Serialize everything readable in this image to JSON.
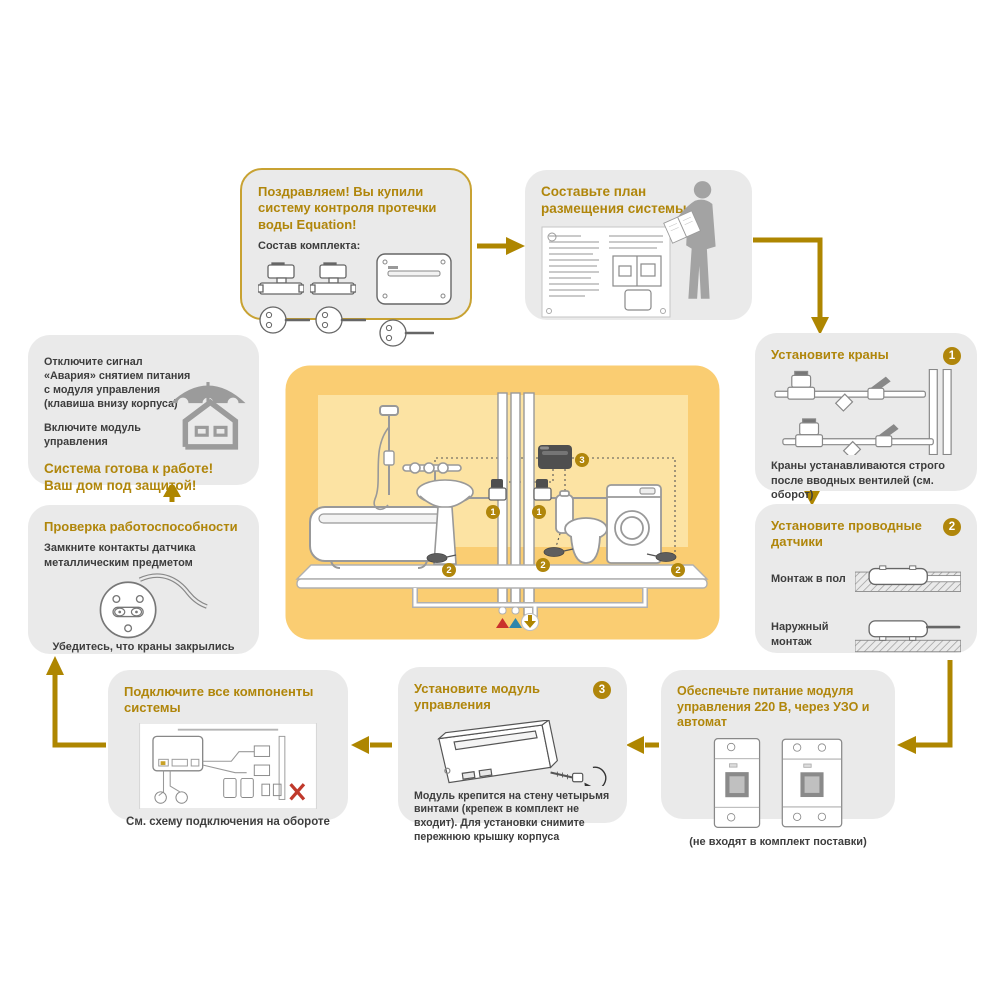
{
  "palette": {
    "accent_gold": "#B0860B",
    "box_gray": "#EAEAEA",
    "scene_yellow": "#FACD72",
    "scene_wall_yellow": "#FCE3A3",
    "hot_water_red": "#C9302C",
    "cold_water_blue": "#2E86AB"
  },
  "steps": {
    "congrats": {
      "title": "Поздравляем! Вы купили систему контроля протечки воды Equation!",
      "kit_label": "Состав комплекта:"
    },
    "plan": {
      "title": "Составьте план размещения системы"
    },
    "install_valves": {
      "badge": "1",
      "title": "Установите краны",
      "caption": "Краны устанавливаются строго после вводных вентилей (см. оборот)"
    },
    "install_sensors": {
      "badge": "2",
      "title": "Установите проводные датчики",
      "floor_mount_label": "Монтаж в пол",
      "surface_mount_label": "Наружный монтаж"
    },
    "power": {
      "title": "Обеспечьте питание модуля управления 220 В, через УЗО и автомат",
      "caption": "(не входят в комплект поставки)"
    },
    "install_module": {
      "badge": "3",
      "title": "Установите модуль управления",
      "caption": "Модуль крепится на стену четырьмя винтами (крепеж в комплект не входит). Для установки снимите пережнюю крышку корпуса"
    },
    "connect": {
      "title": "Подключите все компоненты системы",
      "caption": "См. схему подключения на обороте"
    },
    "test": {
      "title": "Проверка работоспособности",
      "instruction": "Замкните контакты датчика металлическим предметом",
      "caption": "Убедитесь, что краны закрылись"
    },
    "finish": {
      "para1": "Отключите сигнал «Авария» снятием питания с модуля управления (клавиша внизу корпуса)",
      "para2": "Включите модуль управления",
      "ready_line1": "Система готова к работе!",
      "ready_line2": "Ваш дом под защитой!"
    }
  },
  "scene": {
    "badge_valve": "1",
    "badge_sensor": "2",
    "badge_module": "3"
  }
}
